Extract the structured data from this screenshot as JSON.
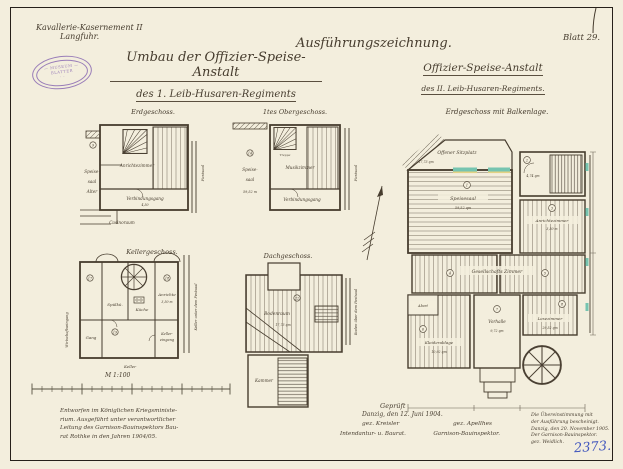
{
  "colors": {
    "paper": "#f3eedd",
    "ink": "#463c2e",
    "stamp_purple": "#8a6ab2",
    "blue_pencil": "#4156bd",
    "window_teal": "#76c4b0",
    "window_yellow": "#e3d284"
  },
  "header": {
    "site_line1": "Kavallerie-Kasernement II",
    "site_line2": "Langfuhr.",
    "stamp": {
      "top": "— MUSEUM —",
      "middle": "BLATTER",
      "bottom": "· ·"
    },
    "title_main": "Umbau der Offizier-Speise-Anstalt",
    "title_sub": "des 1. Leib-Husaren-Regiments",
    "exec_title": "Ausführungszeichnung.",
    "exec_sub1": "Offizier-Speise-Anstalt",
    "exec_sub2": "des II. Leib-Husaren-Regiments.",
    "sheet_no": "Blatt 29."
  },
  "plans": {
    "eg": {
      "title": "Erdgeschoss.",
      "speise_1": "Speise-",
      "speise_2": "saal",
      "speise_3": "Alter",
      "anrichte": "Anrichtezimmer",
      "gang": "Verbindungsgang",
      "gang_dim": "4,50",
      "below": "Casinoraum",
      "right_vertical": "Festsaal",
      "marker": "9"
    },
    "og": {
      "title": "1tes Obergeschoss.",
      "speise_1": "Speise-",
      "speise_2": "saal",
      "speise_3": "59,52 m",
      "treppe": "Treppe",
      "musik": "Musikzimmer",
      "gang": "Verbindungsgang",
      "right_vertical": "Festsaal",
      "marker": "14"
    },
    "kg": {
      "title": "Kellergeschoss.",
      "spulkuche": "Spülkü.",
      "kuche": "Küche",
      "anrichte": "Anrichte",
      "anrichte_dim": "3,50 m",
      "gang": "Gang",
      "keller_eingang_1": "Keller-",
      "keller_eingang_2": "eingang",
      "keller": "Keller",
      "left_vertical": "Wirtschaftseingang",
      "right_vertical": "Keller unter dem Festsaal",
      "marker_1": "17",
      "marker_2": "18",
      "marker_3": "19"
    },
    "dg": {
      "title": "Dachgeschoss.",
      "bodenraum": "Bodenraum",
      "bodenraum_dim": "17,73 qm",
      "kammer": "Kammer",
      "right_vertical": "Boden über dem Festsaal",
      "marker": "22"
    },
    "main": {
      "title": "Erdgeschoss mit Balkenlage.",
      "sitzplatz": "Offener Sitzplatz",
      "sitzplatz_qm": "17,73 qm",
      "speisesaal": "Speisesaal",
      "speisesaal_qm": "59,52 qm",
      "treppe_qm": "4,74 qm",
      "anrichte": "Anrichtezimmer",
      "anrichte_dim": "3,50 m",
      "gesellschaft": "Gesellschafts Zimmer",
      "kleiderablage": "Kleiderablage",
      "kleiderablage_qm": "10,92 qm",
      "abort": "Abort",
      "vorhalle": "Vorhalle",
      "vorhalle_qm": "9,72 qm",
      "lesezimmer": "Lesezimmer",
      "lesezimmer_qm": "29,52 qm",
      "marker_1": "1",
      "marker_2": "2",
      "marker_3": "3",
      "marker_4": "4",
      "marker_5": "5",
      "marker_6": "6",
      "marker_7": "7",
      "marker_8": "8"
    }
  },
  "scale_bar": {
    "label": "M 1:100"
  },
  "notes": {
    "designed_1": "Entworfen im Königlichen Kriegsministe-",
    "designed_2": "rium. Ausgeführt unter verantwortlicher",
    "designed_3": "Leitung des Garnison-Bauinspektors Bau-",
    "designed_4": "rat Rothke in den Jahren 1904/05.",
    "geprueft": "Geprüft",
    "approval_date": "Danzig, den 12. Juni 1904.",
    "sig_left": "gez. Kreisler",
    "sig_right": "gez. Apellhes",
    "role_left": "Intendantur- u. Baurat.",
    "role_right": "Garnison-Bauinspektor.",
    "certify_1": "Die Übereinstimmung mit",
    "certify_2": "der Ausführung bescheinigt.",
    "certify_3": "Danzig, den 20. November 1905.",
    "certify_4": "Der Garnison-Bauinspektor.",
    "certify_5": "gez. Weidlich.",
    "archive_no": "2373."
  }
}
